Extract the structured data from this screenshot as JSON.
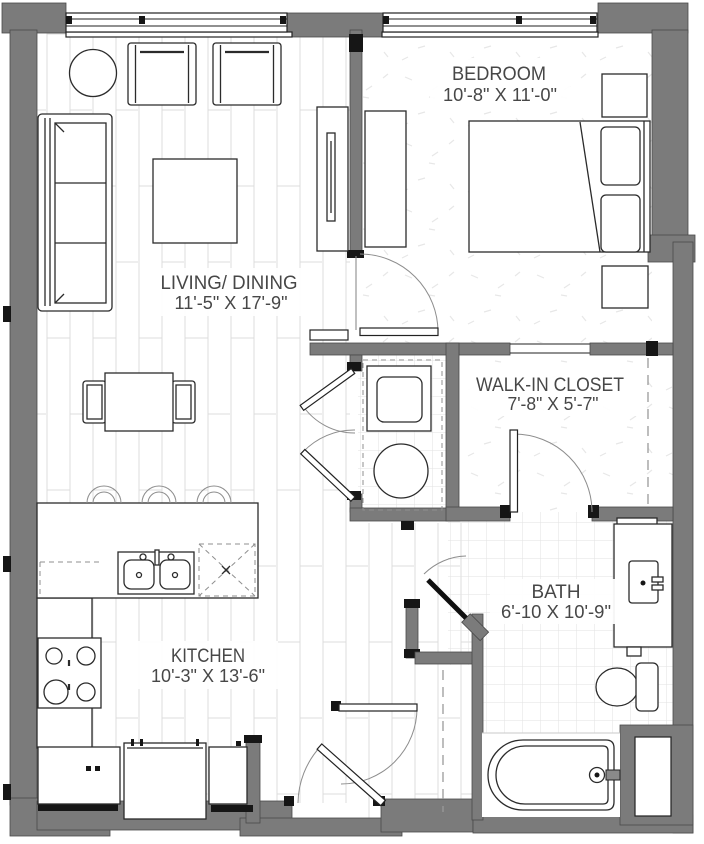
{
  "colors": {
    "wall": "#7b7b7b",
    "wall_edge": "#4a4a4a",
    "line": "#2b2b2b",
    "text": "#474747",
    "floor_line": "#dcdcdc",
    "tile_line": "#e2e2e2"
  },
  "rooms": {
    "living": {
      "name": "LIVING/ DINING",
      "dims": "11'-5\" X 17'-9\""
    },
    "bedroom": {
      "name": "BEDROOM",
      "dims": "10'-8\" X 11'-0\""
    },
    "walkin": {
      "name": "WALK-IN CLOSET",
      "dims": "7'-8\" X 5'-7\""
    },
    "bath": {
      "name": "BATH",
      "dims": "6'-10 X 10'-9\""
    },
    "kitchen": {
      "name": "KITCHEN",
      "dims": "10'-3\" X 13'-6\""
    }
  },
  "fixtures": [
    "sofa",
    "armchair",
    "armchair",
    "round-side-table",
    "coffee-table",
    "tv-console",
    "dining-table",
    "dining-chair",
    "dining-chair",
    "kitchen-island",
    "bar-stool",
    "bar-stool",
    "bar-stool",
    "double-sink",
    "dishwasher",
    "range",
    "refrigerator",
    "base-cabinet",
    "base-cabinet",
    "washer",
    "dryer",
    "bed",
    "pillow",
    "pillow",
    "nightstand",
    "nightstand",
    "dresser",
    "closet-rod",
    "closet-rod",
    "vanity-sink",
    "toilet",
    "bathtub",
    "window",
    "window",
    "entry-door",
    "bedroom-door",
    "bath-door",
    "walk-in-closet-door",
    "laundry-doors",
    "hall-closet-door"
  ]
}
